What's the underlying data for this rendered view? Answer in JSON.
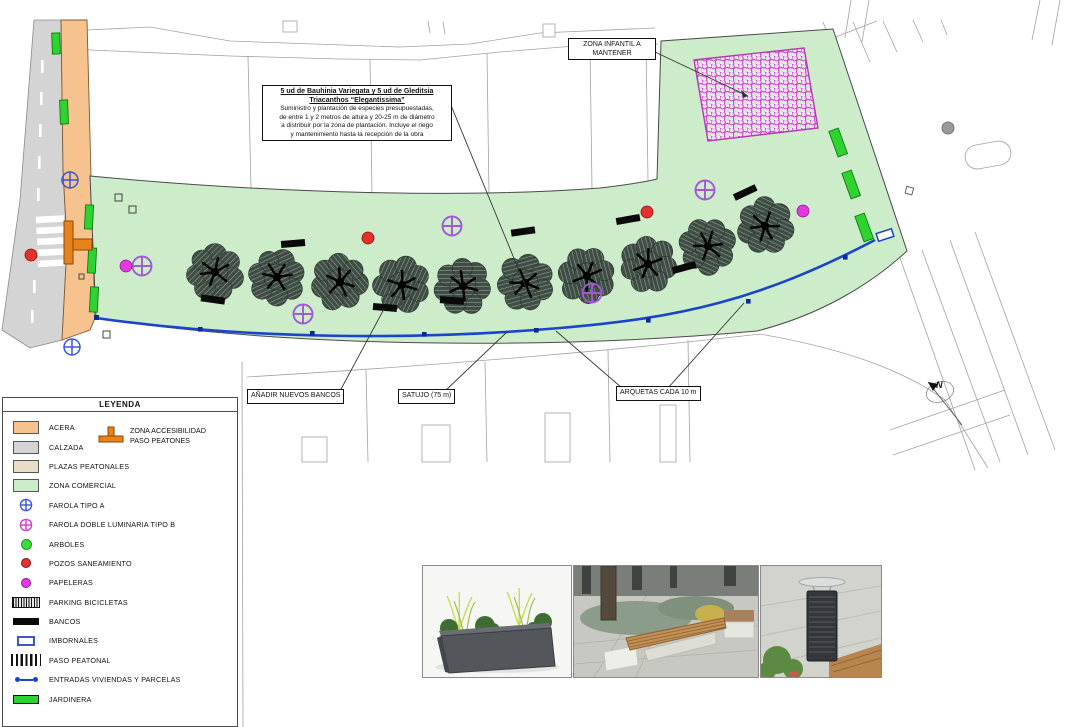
{
  "legend": {
    "title": "LEYENDA",
    "accessibility": {
      "line1": "ZONA ACCESIBILIDAD",
      "line2": "PASO PEATONES"
    },
    "items": [
      {
        "id": "acera",
        "label": "ACERA"
      },
      {
        "id": "calzada",
        "label": "CALZADA"
      },
      {
        "id": "plazas-peatonales",
        "label": "PLAZAS PEATONALES"
      },
      {
        "id": "zona-comercial",
        "label": "ZONA COMERCIAL"
      },
      {
        "id": "farola-tipo-a",
        "label": "FAROLA TIPO A"
      },
      {
        "id": "farola-doble-luminaria-tipo-b",
        "label": "FAROLA DOBLE LUMINARIA TIPO B"
      },
      {
        "id": "arboles",
        "label": "ARBOLES"
      },
      {
        "id": "pozos-saneamiento",
        "label": "POZOS SANEAMIENTO"
      },
      {
        "id": "papeleras",
        "label": "PAPELERAS"
      },
      {
        "id": "parking-bicicletas",
        "label": "PARKING BICICLETAS"
      },
      {
        "id": "bancos",
        "label": "BANCOS"
      },
      {
        "id": "imbornales",
        "label": "IMBORNALES"
      },
      {
        "id": "paso-peatonal",
        "label": "PASO PEATONAL"
      },
      {
        "id": "entradas-viviendas",
        "label": "ENTRADAS VIVIENDAS Y PARCELAS"
      },
      {
        "id": "jardinera",
        "label": "JARDINERA"
      }
    ]
  },
  "annotations": {
    "planting_note": {
      "title_line1": "5 ud de Bauhinia Variegata y 5 ud de Gleditsia",
      "title_line2": "Triacanthos “Elegantissima”",
      "body_line1": "Suministro y plantación de especies presupuestadas,",
      "body_line2": "de entre 1 y 2 metros de altura y 20-25 m de diámetro",
      "body_line3": "a distribuir por la zona de plantación. Incluye el riego",
      "body_line4": "y mantenimiento hasta la recepción de la obra"
    },
    "zona_infantil_line1": "ZONA INFANTIL A",
    "zona_infantil_line2": "MANTENER",
    "anadir_bancos": "AÑADIR NUEVOS BANCOS",
    "satujo": "SATUJO (75 m)",
    "arquetas": "ARQUETAS CADA 10 m"
  },
  "compass": {
    "north_label": "N"
  },
  "colors": {
    "acera": "#f6c28e",
    "calzada": "#d4d4d4",
    "plazas_peatonales": "#eadcc6",
    "zona_comercial": "#cdecca",
    "jardinera": "#2fd32f",
    "farola_tipo_a": "#3a56d4",
    "farola_tipo_b": "#a257d6",
    "arboles": "#3ddc3d",
    "pozos_saneamiento": "#e53030",
    "papeleras": "#e23ae2",
    "linea_servicio": "#1b44cc",
    "zona_infantil_trama": "#c43cc4",
    "acceso_peatones_icono": "#e8821e"
  }
}
